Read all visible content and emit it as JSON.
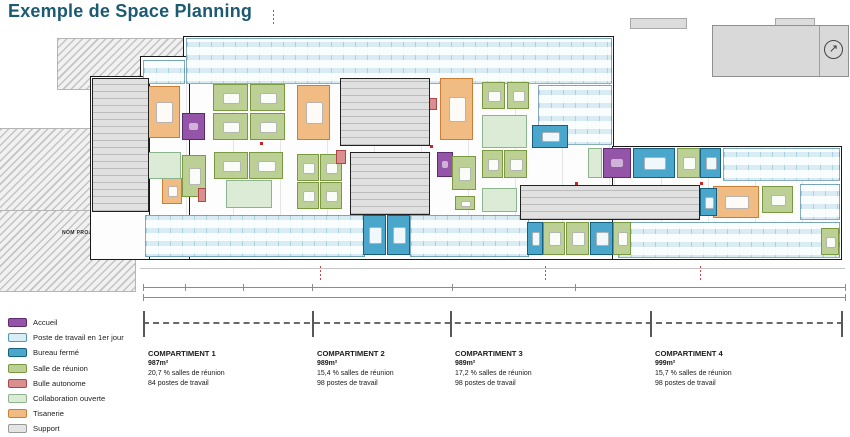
{
  "header": {
    "title": "Exemple de Space Planning",
    "title_color": "#1b5a72"
  },
  "plan": {
    "project_label": "NOM PROJET",
    "north_icon": "north-arrow-icon"
  },
  "legend": {
    "items": [
      {
        "label": "Accueil",
        "fill": "#9455a8",
        "border": "#5c2a6e"
      },
      {
        "label": "Poste de travail en 1er jour",
        "fill": "#d8edf5",
        "border": "#4d9ab5"
      },
      {
        "label": "Bureau fermé",
        "fill": "#4aa6cb",
        "border": "#16607f"
      },
      {
        "label": "Salle de réunion",
        "fill": "#bcd096",
        "border": "#7a9a42"
      },
      {
        "label": "Bulle autonome",
        "fill": "#d98f8f",
        "border": "#b04545"
      },
      {
        "label": "Collaboration ouverte",
        "fill": "#dcebd6",
        "border": "#8bb48f"
      },
      {
        "label": "Tisanerie",
        "fill": "#f0bc84",
        "border": "#c98036"
      },
      {
        "label": "Support",
        "fill": "#e4e4e4",
        "border": "#999999"
      }
    ]
  },
  "compartments": [
    {
      "name": "COMPARTIMENT 1",
      "area": "987m²",
      "meeting": "20,7 % salles de réunion",
      "desks": "84 postes de travail"
    },
    {
      "name": "COMPARTIMENT 2",
      "area": "989m²",
      "meeting": "15,4 % salles de réunion",
      "desks": "98 postes de travail"
    },
    {
      "name": "COMPARTIMENT 3",
      "area": "989m²",
      "meeting": "17,2 % salles de réunion",
      "desks": "98 postes de travail"
    },
    {
      "name": "COMPARTIMENT 4",
      "area": "999m²",
      "meeting": "15,7 % salles de réunion",
      "desks": "98 postes de travail"
    }
  ]
}
